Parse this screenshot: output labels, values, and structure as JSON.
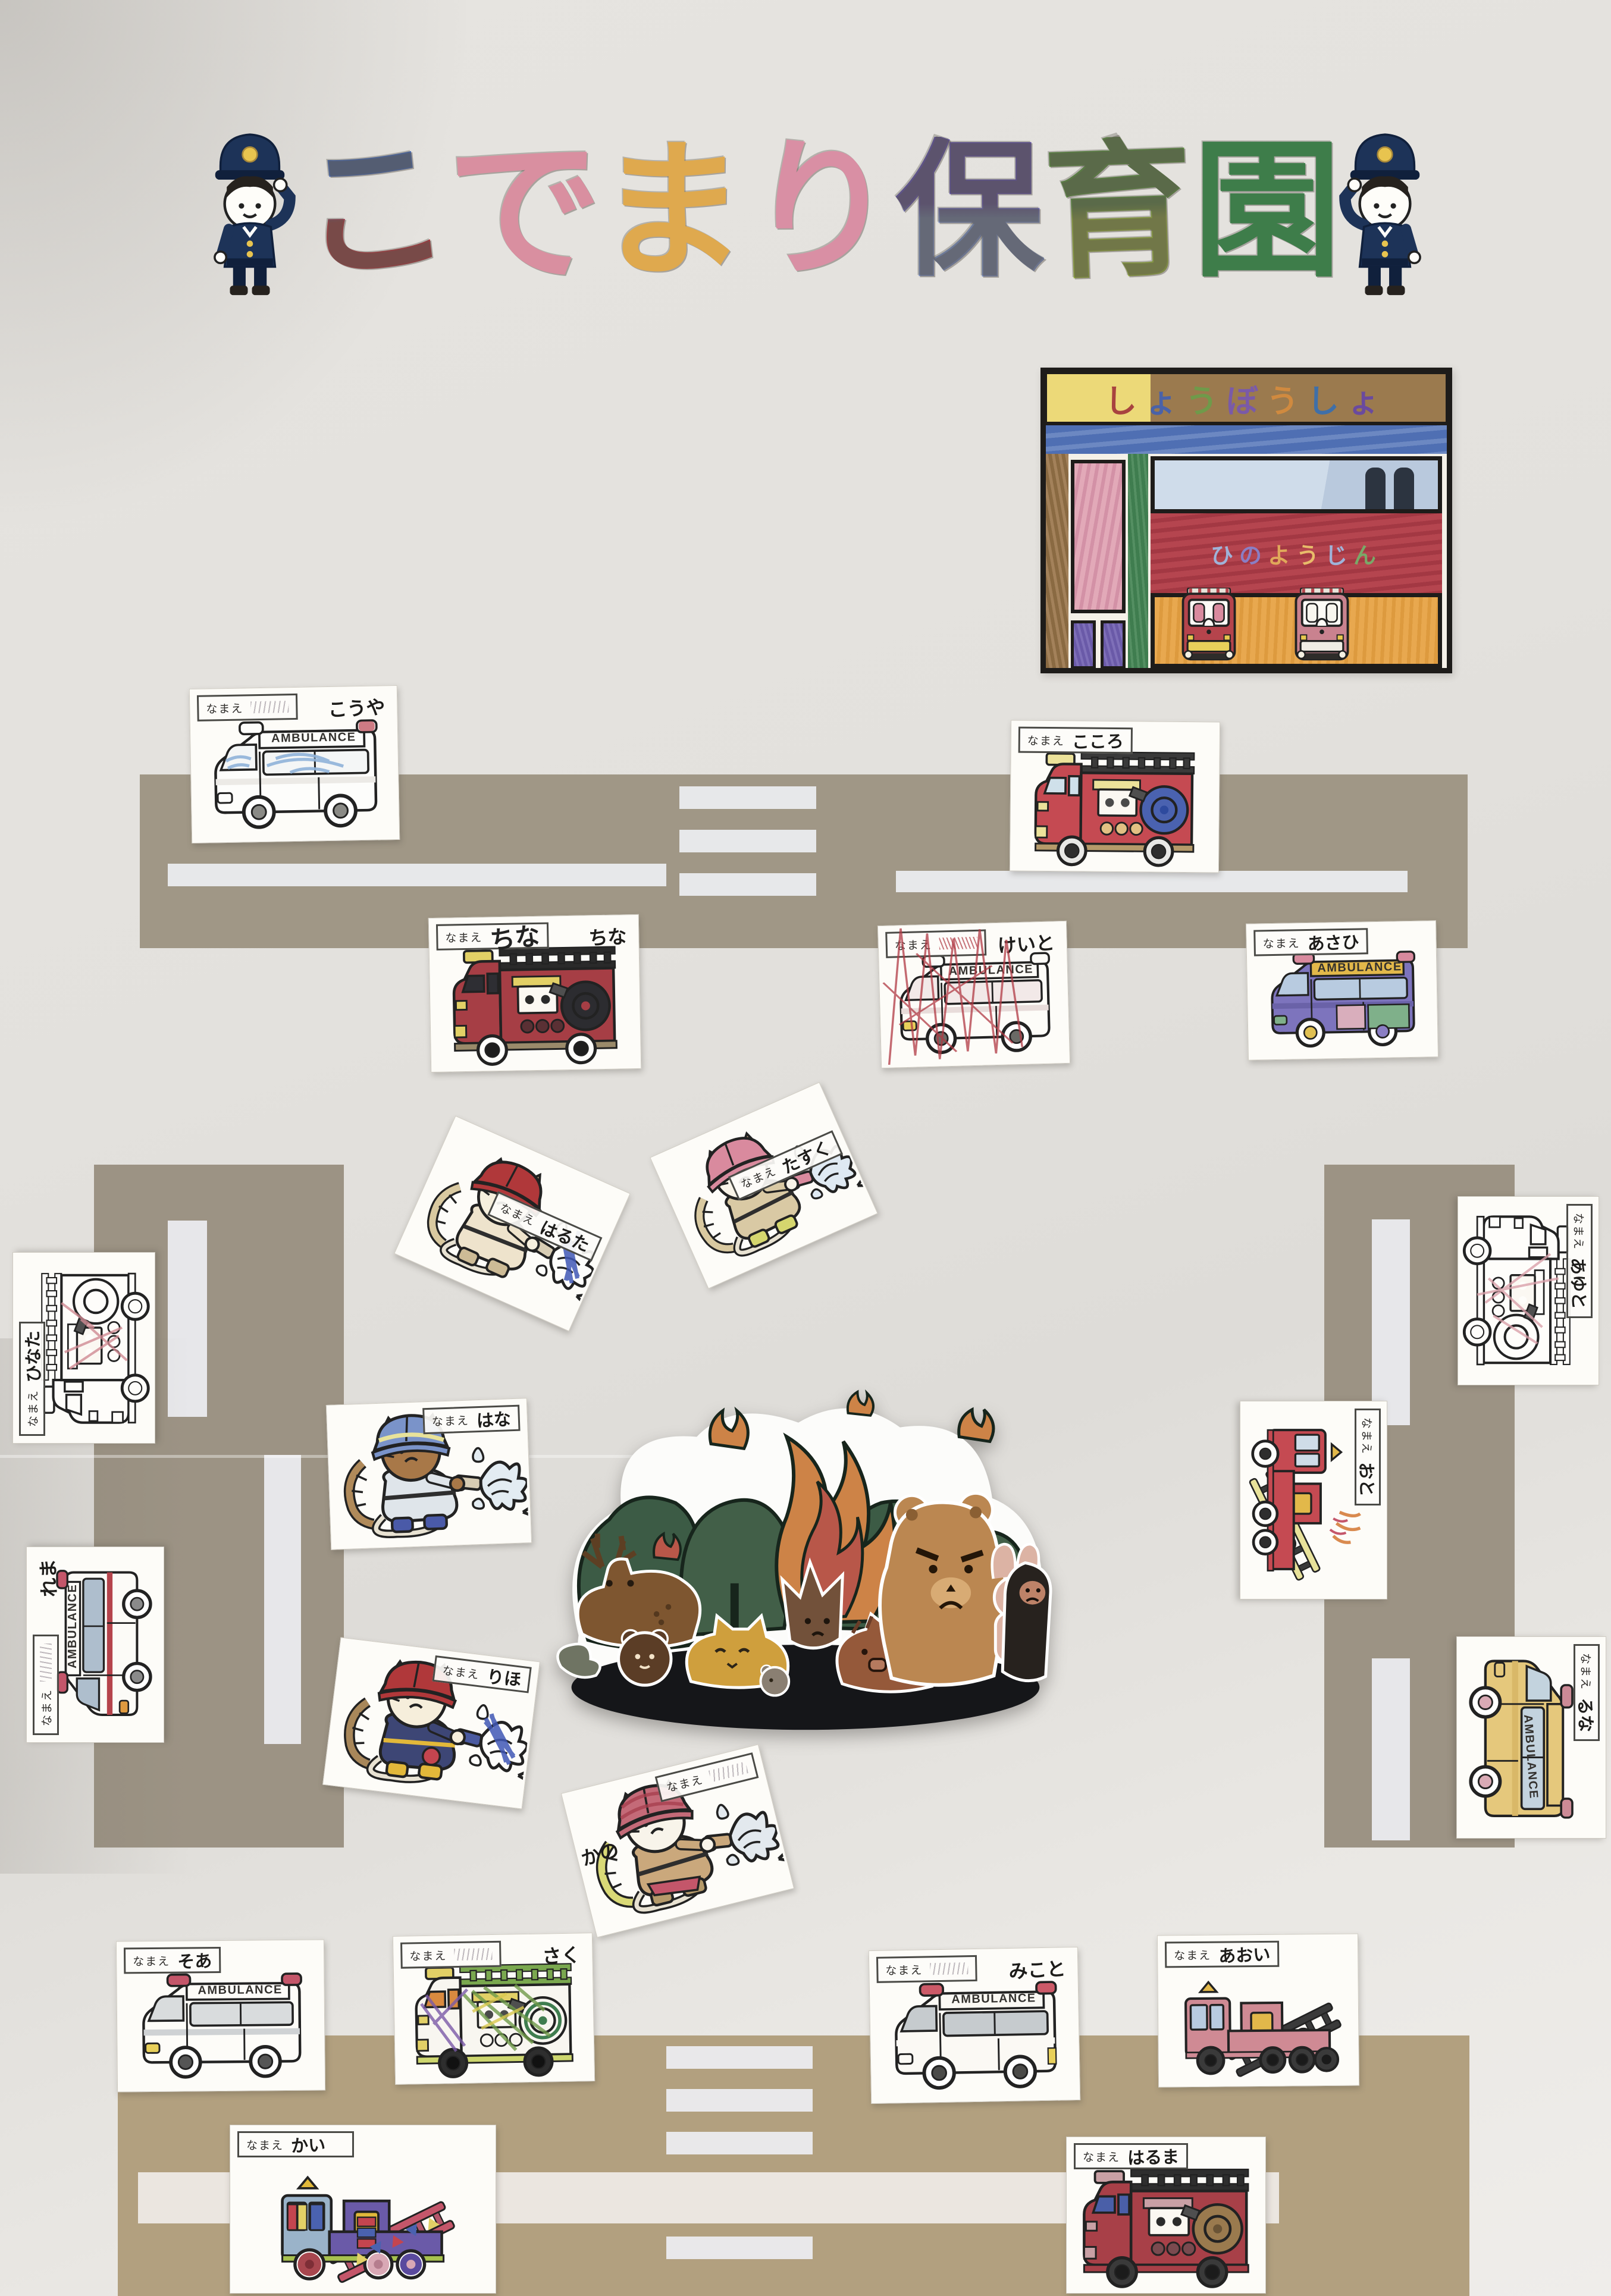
{
  "poster": {
    "title": "こでまり保育園",
    "title_letters": [
      {
        "char": "こ",
        "color": "#4a6cb5",
        "color2": "#b0383f"
      },
      {
        "char": "で",
        "color": "#d98fa0"
      },
      {
        "char": "ま",
        "color": "#dfa94e"
      },
      {
        "char": "り",
        "color": "#d98fa4"
      },
      {
        "char": "保",
        "color": "#6252a8",
        "color2": "#7a8fc4"
      },
      {
        "char": "育",
        "color": "#5b9141",
        "color2": "#9ab53f"
      },
      {
        "char": "園",
        "color": "#3e7d4a"
      }
    ],
    "paper_color": "#e4e2de",
    "road_color": "#a09786",
    "road_color_bottom": "#b2a07f"
  },
  "fire_station": {
    "banner": "しょうぼうしょ",
    "banner_letters": [
      {
        "char": "し",
        "color": "#a8433f"
      },
      {
        "char": "ょ",
        "color": "#4a62a8"
      },
      {
        "char": "う",
        "color": "#6f9a4a"
      },
      {
        "char": "ぼ",
        "color": "#7a5aa8"
      },
      {
        "char": "う",
        "color": "#d08a3f"
      },
      {
        "char": "し",
        "color": "#3f6fa8"
      },
      {
        "char": "ょ",
        "color": "#6a4a9e"
      }
    ],
    "sign": "ひのようじん",
    "sign_letters": [
      {
        "char": "ひ",
        "color": "#9fb3d9"
      },
      {
        "char": "の",
        "color": "#8a7ec4"
      },
      {
        "char": "よ",
        "color": "#e0a85a"
      },
      {
        "char": "う",
        "color": "#e8bc6a"
      },
      {
        "char": "じ",
        "color": "#9fb3d9"
      },
      {
        "char": "ん",
        "color": "#7aa868"
      }
    ]
  },
  "labels": {
    "name_label": "なまえ",
    "ambulance": "AMBULANCE"
  },
  "cards": [
    {
      "name": "こうや",
      "vehicle": "ambulance"
    },
    {
      "name": "こころ",
      "vehicle": "fire-engine"
    },
    {
      "name": "ちな",
      "vehicle": "fire-engine"
    },
    {
      "name": "けいと",
      "vehicle": "ambulance"
    },
    {
      "name": "あさひ",
      "vehicle": "ambulance"
    },
    {
      "name": "はるた",
      "vehicle": "firefighter-cat"
    },
    {
      "name": "たすく",
      "vehicle": "firefighter-cat"
    },
    {
      "name": "ひなた",
      "vehicle": "fire-engine"
    },
    {
      "name": "あゆと",
      "vehicle": "fire-engine"
    },
    {
      "name": "はな",
      "vehicle": "firefighter-cat"
    },
    {
      "name": "おと",
      "vehicle": "ladder-truck"
    },
    {
      "name": "れま",
      "vehicle": "ambulance"
    },
    {
      "name": "るな",
      "vehicle": "ambulance"
    },
    {
      "name": "りほ",
      "vehicle": "firefighter-cat"
    },
    {
      "name": "かの",
      "vehicle": "firefighter-cat"
    },
    {
      "name": "そあ",
      "vehicle": "ambulance"
    },
    {
      "name": "さく",
      "vehicle": "fire-engine"
    },
    {
      "name": "みこと",
      "vehicle": "ambulance"
    },
    {
      "name": "あおい",
      "vehicle": "ladder-truck"
    },
    {
      "name": "かい",
      "vehicle": "ladder-truck"
    },
    {
      "name": "はるま",
      "vehicle": "fire-engine"
    }
  ]
}
